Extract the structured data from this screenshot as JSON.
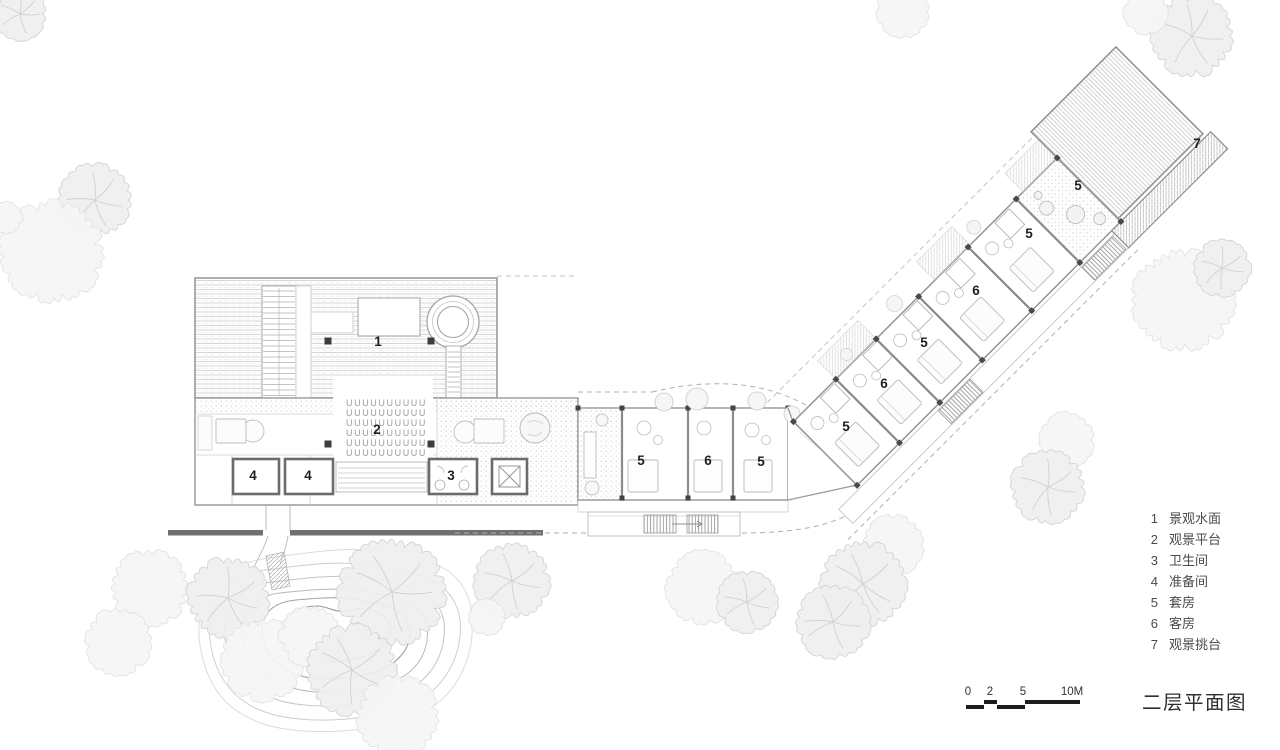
{
  "title": "二层平面图",
  "legend": {
    "items": [
      {
        "num": "1",
        "label": "景观水面"
      },
      {
        "num": "2",
        "label": "观景平台"
      },
      {
        "num": "3",
        "label": "卫生间"
      },
      {
        "num": "4",
        "label": "准备间"
      },
      {
        "num": "5",
        "label": "套房"
      },
      {
        "num": "6",
        "label": "客房"
      },
      {
        "num": "7",
        "label": "观景挑台"
      }
    ]
  },
  "scale_bar": {
    "ticks": [
      {
        "text": "0",
        "x": 968
      },
      {
        "text": "2",
        "x": 990
      },
      {
        "text": "5",
        "x": 1023
      },
      {
        "text": "10M",
        "x": 1072
      }
    ]
  },
  "plan": {
    "room_labels": [
      {
        "text": "1",
        "x": 378,
        "y": 346
      },
      {
        "text": "2",
        "x": 377,
        "y": 434
      },
      {
        "text": "4",
        "x": 253,
        "y": 480
      },
      {
        "text": "4",
        "x": 308,
        "y": 480
      },
      {
        "text": "3",
        "x": 451,
        "y": 480
      },
      {
        "text": "5",
        "x": 641,
        "y": 465
      },
      {
        "text": "6",
        "x": 708,
        "y": 465
      },
      {
        "text": "5",
        "x": 761,
        "y": 466
      },
      {
        "text": "5",
        "x": 846,
        "y": 431
      },
      {
        "text": "6",
        "x": 884,
        "y": 388
      },
      {
        "text": "5",
        "x": 924,
        "y": 347
      },
      {
        "text": "6",
        "x": 976,
        "y": 295
      },
      {
        "text": "5",
        "x": 1029,
        "y": 238
      },
      {
        "text": "5",
        "x": 1078,
        "y": 190
      },
      {
        "text": "7",
        "x": 1197,
        "y": 148
      }
    ]
  }
}
